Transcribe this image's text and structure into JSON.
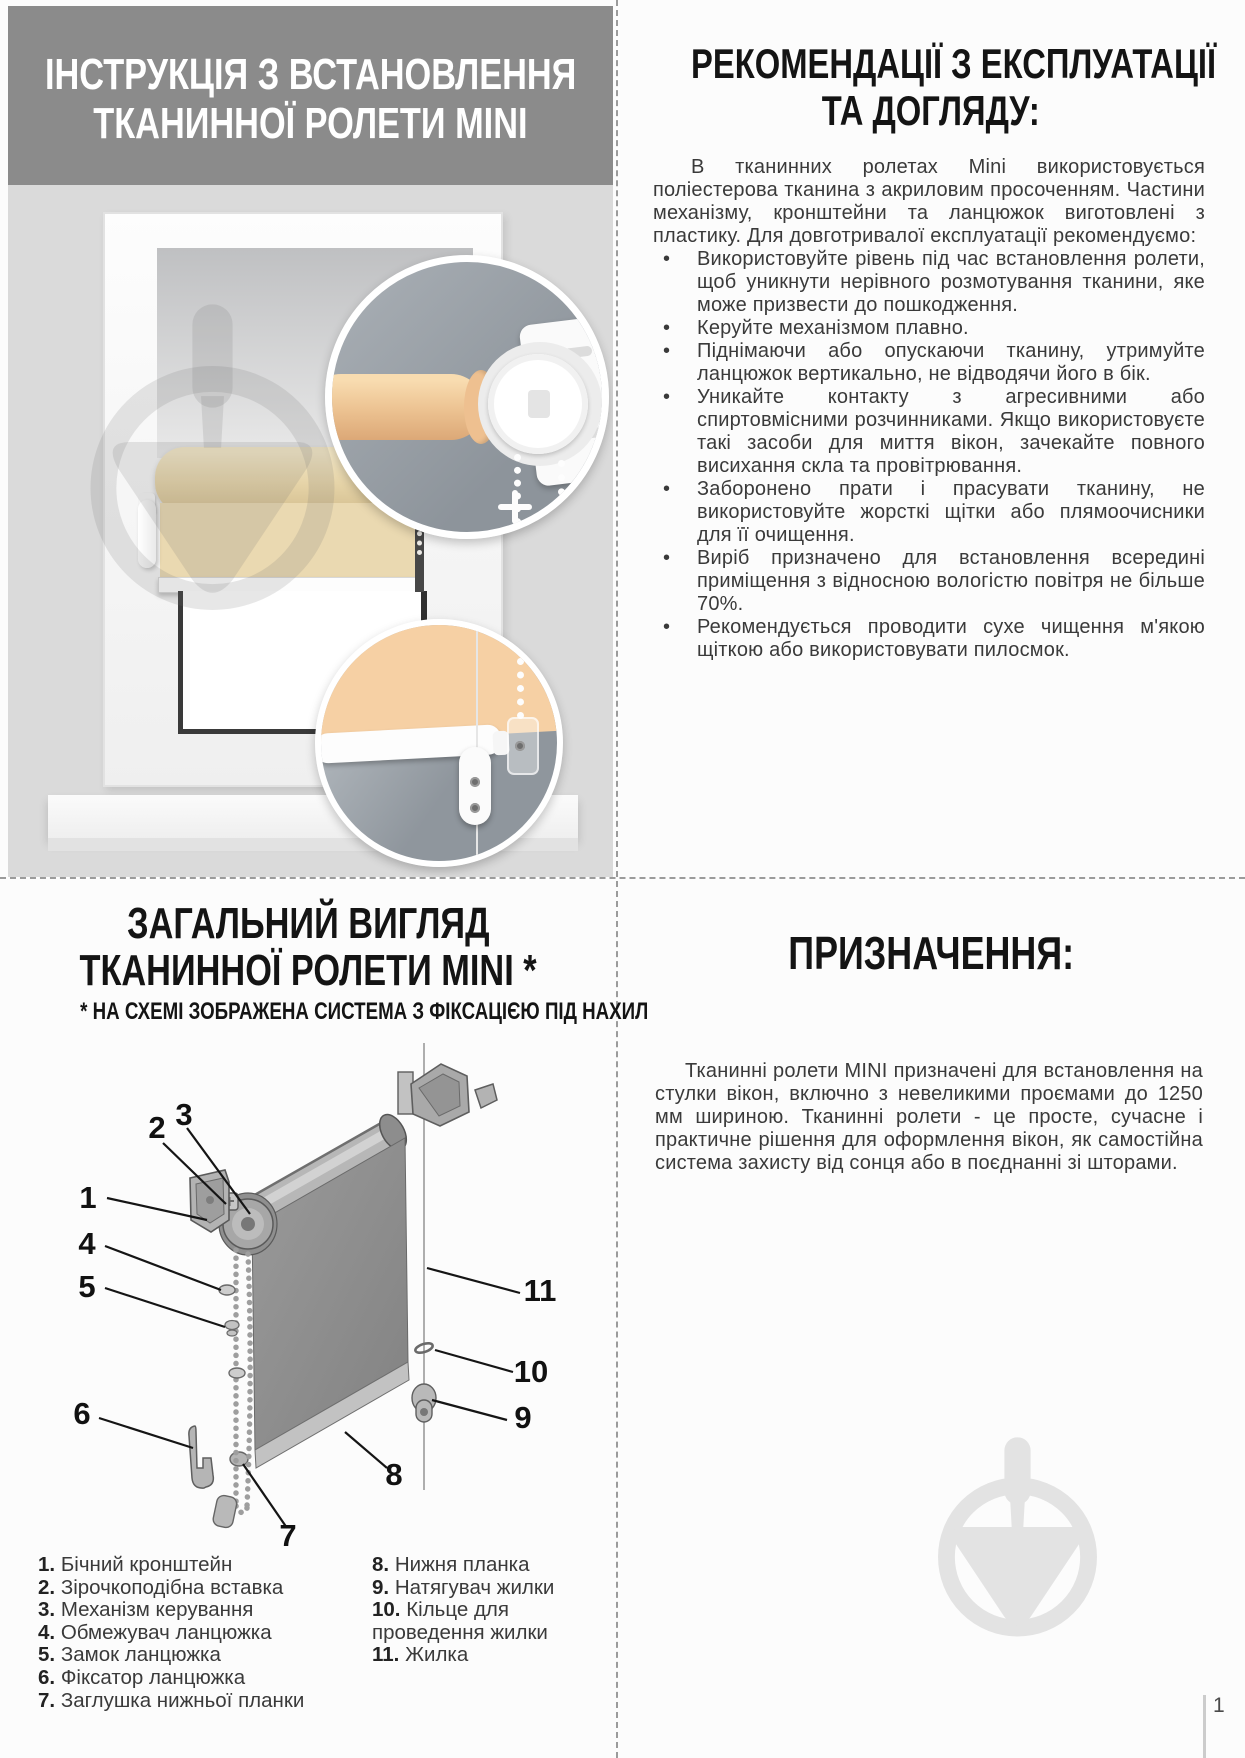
{
  "install_section": {
    "title_line1": "ІНСТРУКЦІЯ З ВСТАНОВЛЕННЯ",
    "title_line2": "ТКАНИННОЇ РОЛЕТИ MINI"
  },
  "recommendations_section": {
    "title_line1": "РЕКОМЕНДАЦІЇ З ЕКСПЛУАТАЦІЇ",
    "title_line2": "ТА ДОГЛЯДУ:",
    "intro": "В тканинних ролетах Mini використовується поліестерова тканина з акриловим просоченням. Частини механізму, кронштейни та ланцюжок виготовлені з пластику. Для довготривалої експлуатації рекомендуємо:",
    "bullets": [
      "Використовуйте рівень під час встановлення ролети, щоб уникнути нерівного розмотування тканини, яке може призвести до пошкодження.",
      "Керуйте механізмом плавно.",
      "Піднімаючи або опускаючи тканину, утримуйте ланцюжок вертикально, не відводячи його в бік.",
      "Уникайте контакту з агресивними або спиртовмісними розчинниками. Якщо використовуєте такі засоби для миття вікон, зачекайте повного висихання скла та провітрювання.",
      "Заборонено прати і прасувати тканину, не використовуйте жорсткі щітки або плямоочисники для її очищення.",
      "Виріб призначено для встановлення всередині приміщення з відносною вологістю повітря не більше 70%.",
      "Рекомендується проводити сухе чищення м'якою щіткою або використовувати пилосмок."
    ]
  },
  "overview_section": {
    "title_line1": "ЗАГАЛЬНИЙ ВИГЛЯД",
    "title_line2": "ТКАНИННОЇ РОЛЕТИ MINI *",
    "subtitle": "* НА СХЕМІ ЗОБРАЖЕНА СИСТЕМА З ФІКСАЦІЄЮ ПІД НАХИЛ",
    "callouts": [
      "1",
      "2",
      "3",
      "4",
      "5",
      "6",
      "7",
      "8",
      "9",
      "10",
      "11"
    ],
    "legend_col1": [
      {
        "num": "1.",
        "label": "Бічний кронштейн"
      },
      {
        "num": "2.",
        "label": "Зірочкоподібна вставка"
      },
      {
        "num": "3.",
        "label": "Механізм керування"
      },
      {
        "num": "4.",
        "label": "Обмежувач ланцюжка"
      },
      {
        "num": "5.",
        "label": "Замок ланцюжка"
      },
      {
        "num": "6.",
        "label": "Фіксатор ланцюжка"
      },
      {
        "num": "7.",
        "label": "Заглушка нижньої планки"
      }
    ],
    "legend_col2": [
      {
        "num": "8.",
        "label": "Нижня планка"
      },
      {
        "num": "9.",
        "label": "Натягувач жилки"
      },
      {
        "num": "10.",
        "label": "Кільце для проведення жилки"
      },
      {
        "num": "11.",
        "label": "Жилка"
      }
    ]
  },
  "purpose_section": {
    "title": "ПРИЗНАЧЕННЯ:",
    "body": "Тканинні ролети MINI призначені для встановлення на стулки вікон, включно з невеликими проємами до 1250 мм шириною. Тканинні ролети - це просте, сучасне і практичне рішення для оформлення вікон, як самостійна система захисту від сонця або в поєднанні зі шторами."
  },
  "footer": {
    "page_number": "1"
  },
  "colors": {
    "header_gray": "#8b8b8b",
    "wall_gray": "#dadada",
    "blind_beige": "#ead9b1",
    "inset_gray": "#9aa0a7",
    "watermark_gray": "#e3e3e3",
    "text_dark": "#3a3a3a"
  }
}
